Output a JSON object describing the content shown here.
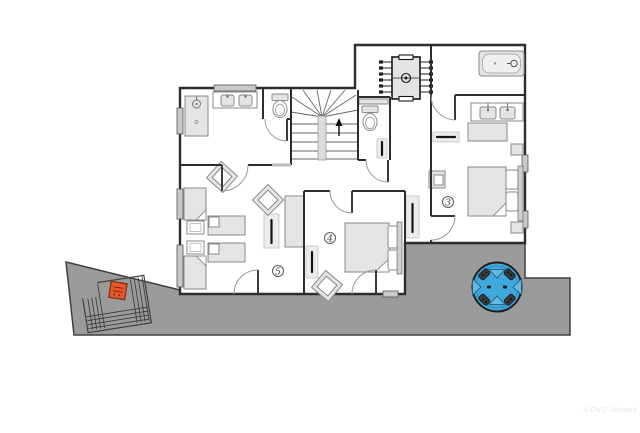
{
  "watermark": {
    "text": "© OVO Network"
  },
  "rooms": [
    {
      "label": "3",
      "name": "bedroom-3"
    },
    {
      "label": "4",
      "name": "bedroom-4"
    },
    {
      "label": "5",
      "name": "bedroom-5"
    }
  ],
  "icons": [
    "shower",
    "double-vanity",
    "sink",
    "toilet",
    "wc-toilet",
    "bathtub",
    "staircase-up-arrow",
    "foosball-table",
    "double-bed",
    "single-bed",
    "nightstand",
    "wardrobe",
    "radiator",
    "armchair",
    "desk-chair",
    "door-swing",
    "window",
    "terrace",
    "terrace-steps",
    "gate",
    "barbecue",
    "hot-tub"
  ],
  "colors": {
    "background": "#ffffff",
    "wall": "#2d2d2d",
    "terrace": "#9b9b9b",
    "terrace_line": "#3f3f3f",
    "furniture_fill": "#e4e4e4",
    "furniture_line": "#8a8a8a",
    "hot_tub_blue": "#3fa9dd",
    "barbecue_orange": "#e8592a",
    "window_gray": "#c9c9c9",
    "radiator_black": "#141414",
    "door_arc": "#9a9a9a",
    "stair_line": "#666666",
    "label_gray": "#3c3c3c",
    "watermark_gray": "#e7e7e7"
  }
}
